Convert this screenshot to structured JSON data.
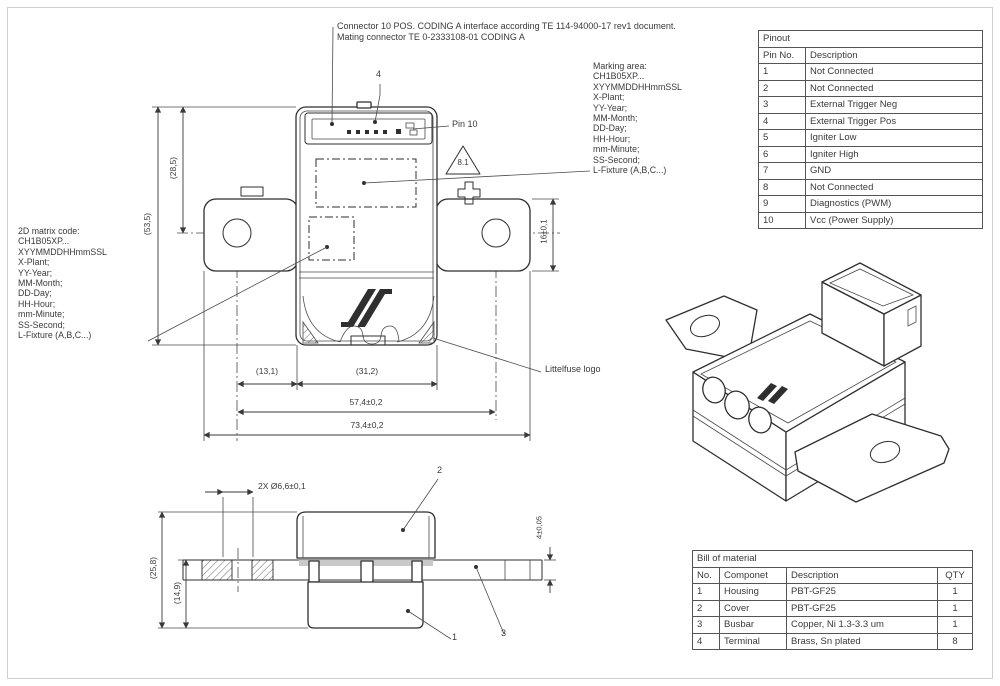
{
  "colors": {
    "line": "#2f2f2f",
    "dim": "#3a3a3a",
    "frame": "#cfcfcf",
    "shade": "#c9c9c9"
  },
  "notes": {
    "connector_note_line1": "Connector 10 POS. CODING A interface according TE 114-94000-17 rev1 document.",
    "connector_note_line2": "Mating connector TE 0-2333108-01 CODING A"
  },
  "pinout_table": {
    "title": "Pinout",
    "columns": [
      "Pin No.",
      "Description"
    ],
    "rows": [
      [
        "1",
        "Not Connected"
      ],
      [
        "2",
        "Not Connected"
      ],
      [
        "3",
        "External Trigger Neg"
      ],
      [
        "4",
        "External Trigger Pos"
      ],
      [
        "5",
        "Igniter Low"
      ],
      [
        "6",
        "Igniter High"
      ],
      [
        "7",
        "GND"
      ],
      [
        "8",
        "Not Connected"
      ],
      [
        "9",
        "Diagnostics (PWM)"
      ],
      [
        "10",
        "Vcc (Power Supply)"
      ]
    ]
  },
  "bom_table": {
    "title": "Bill of material",
    "columns": [
      "No.",
      "Componet",
      "Description",
      "QTY"
    ],
    "rows": [
      [
        "1",
        "Housing",
        "PBT-GF25",
        "1"
      ],
      [
        "2",
        "Cover",
        "PBT-GF25",
        "1"
      ],
      [
        "3",
        "Busbar",
        "Copper, Ni 1.3-3.3 um",
        "1"
      ],
      [
        "4",
        "Terminal",
        "Brass, Sn plated",
        "8"
      ]
    ]
  },
  "marking_area": {
    "lines": [
      "Marking area:",
      "CH1B05XP...",
      "XYYMMDDHHmmSSL",
      "X-Plant;",
      "YY-Year;",
      "MM-Month;",
      "DD-Day;",
      "HH-Hour;",
      "mm-Minute;",
      "SS-Second;",
      "L-Fixture (A,B,C...)"
    ]
  },
  "matrix_code": {
    "lines": [
      "2D matrix code:",
      "CH1B05XP...",
      "XYYMMDDHHmmSSL",
      "X-Plant;",
      "YY-Year;",
      "MM-Month;",
      "DD-Day;",
      "HH-Hour;",
      "mm-Minute;",
      "SS-Second;",
      "L-Fixture (A,B,C...)"
    ]
  },
  "front_view": {
    "dims": {
      "height_upper": "(28,5)",
      "height_total": "(53,5)",
      "tab_height": "16±0,1",
      "hole_offset": "(13,1)",
      "body_width": "(31,2)",
      "hole_pitch": "57,4±0,2",
      "overall_width": "73,4±0,2"
    },
    "labels": {
      "pin10": "Pin 10",
      "connector_callout": "4",
      "note_triangle": "8.1",
      "logo_label": "Littelfuse logo"
    }
  },
  "section_view": {
    "dims": {
      "hole_dia": "2X Ø6,6±0,1",
      "total_height": "(25,8)",
      "lower_height": "(14,9)",
      "busbar_thickness": "4±0,05"
    },
    "callouts": {
      "housing": "1",
      "cover": "2",
      "busbar": "3"
    }
  }
}
